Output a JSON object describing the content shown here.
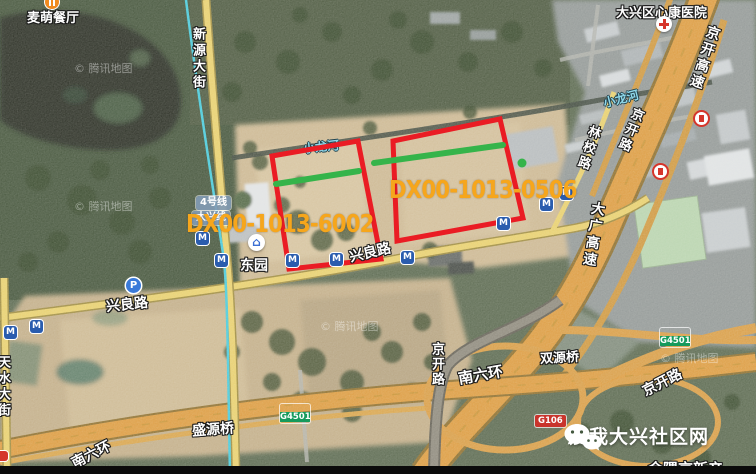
{
  "map_type": "satellite",
  "watermark": "© 腾讯地图",
  "pois": {
    "restaurant": "麦萌餐厅",
    "hospital": "大兴区心康医院",
    "station": "东园",
    "line4_badge": "4号线",
    "daxing_line_badge": "大兴线"
  },
  "roads": {
    "xinyuan_street": "新源大街",
    "jingkai_expressway": "京开高速",
    "jingkai_road": "京开路",
    "linxiao_road": "林校路",
    "daguang_expressway": "大广高速",
    "xingliang_road": "兴良路",
    "south_sixth_ring": "南六环",
    "tianshui_street": "天水大街",
    "shengyuan_bridge": "盛源桥",
    "shuangyuan_bridge": "双源桥",
    "xiaolong_river": "小龙河",
    "g4501": "G4501",
    "g106": "G106"
  },
  "parcels": [
    {
      "id": "DX00-1013-6002",
      "outline_color": "#ea1c24",
      "inner_line_color": "#35b44a",
      "label_color": "#f6a61c"
    },
    {
      "id": "DX00-1013-0506",
      "outline_color": "#ea1c24",
      "inner_line_color": "#35b44a",
      "label_color": "#f6a61c"
    }
  ],
  "footer": {
    "community_name": "爱我大兴社区网",
    "partial_text": "金隅京新产"
  },
  "icons": {
    "metro": "M",
    "parking": "P",
    "station_entrance": "⌂"
  }
}
